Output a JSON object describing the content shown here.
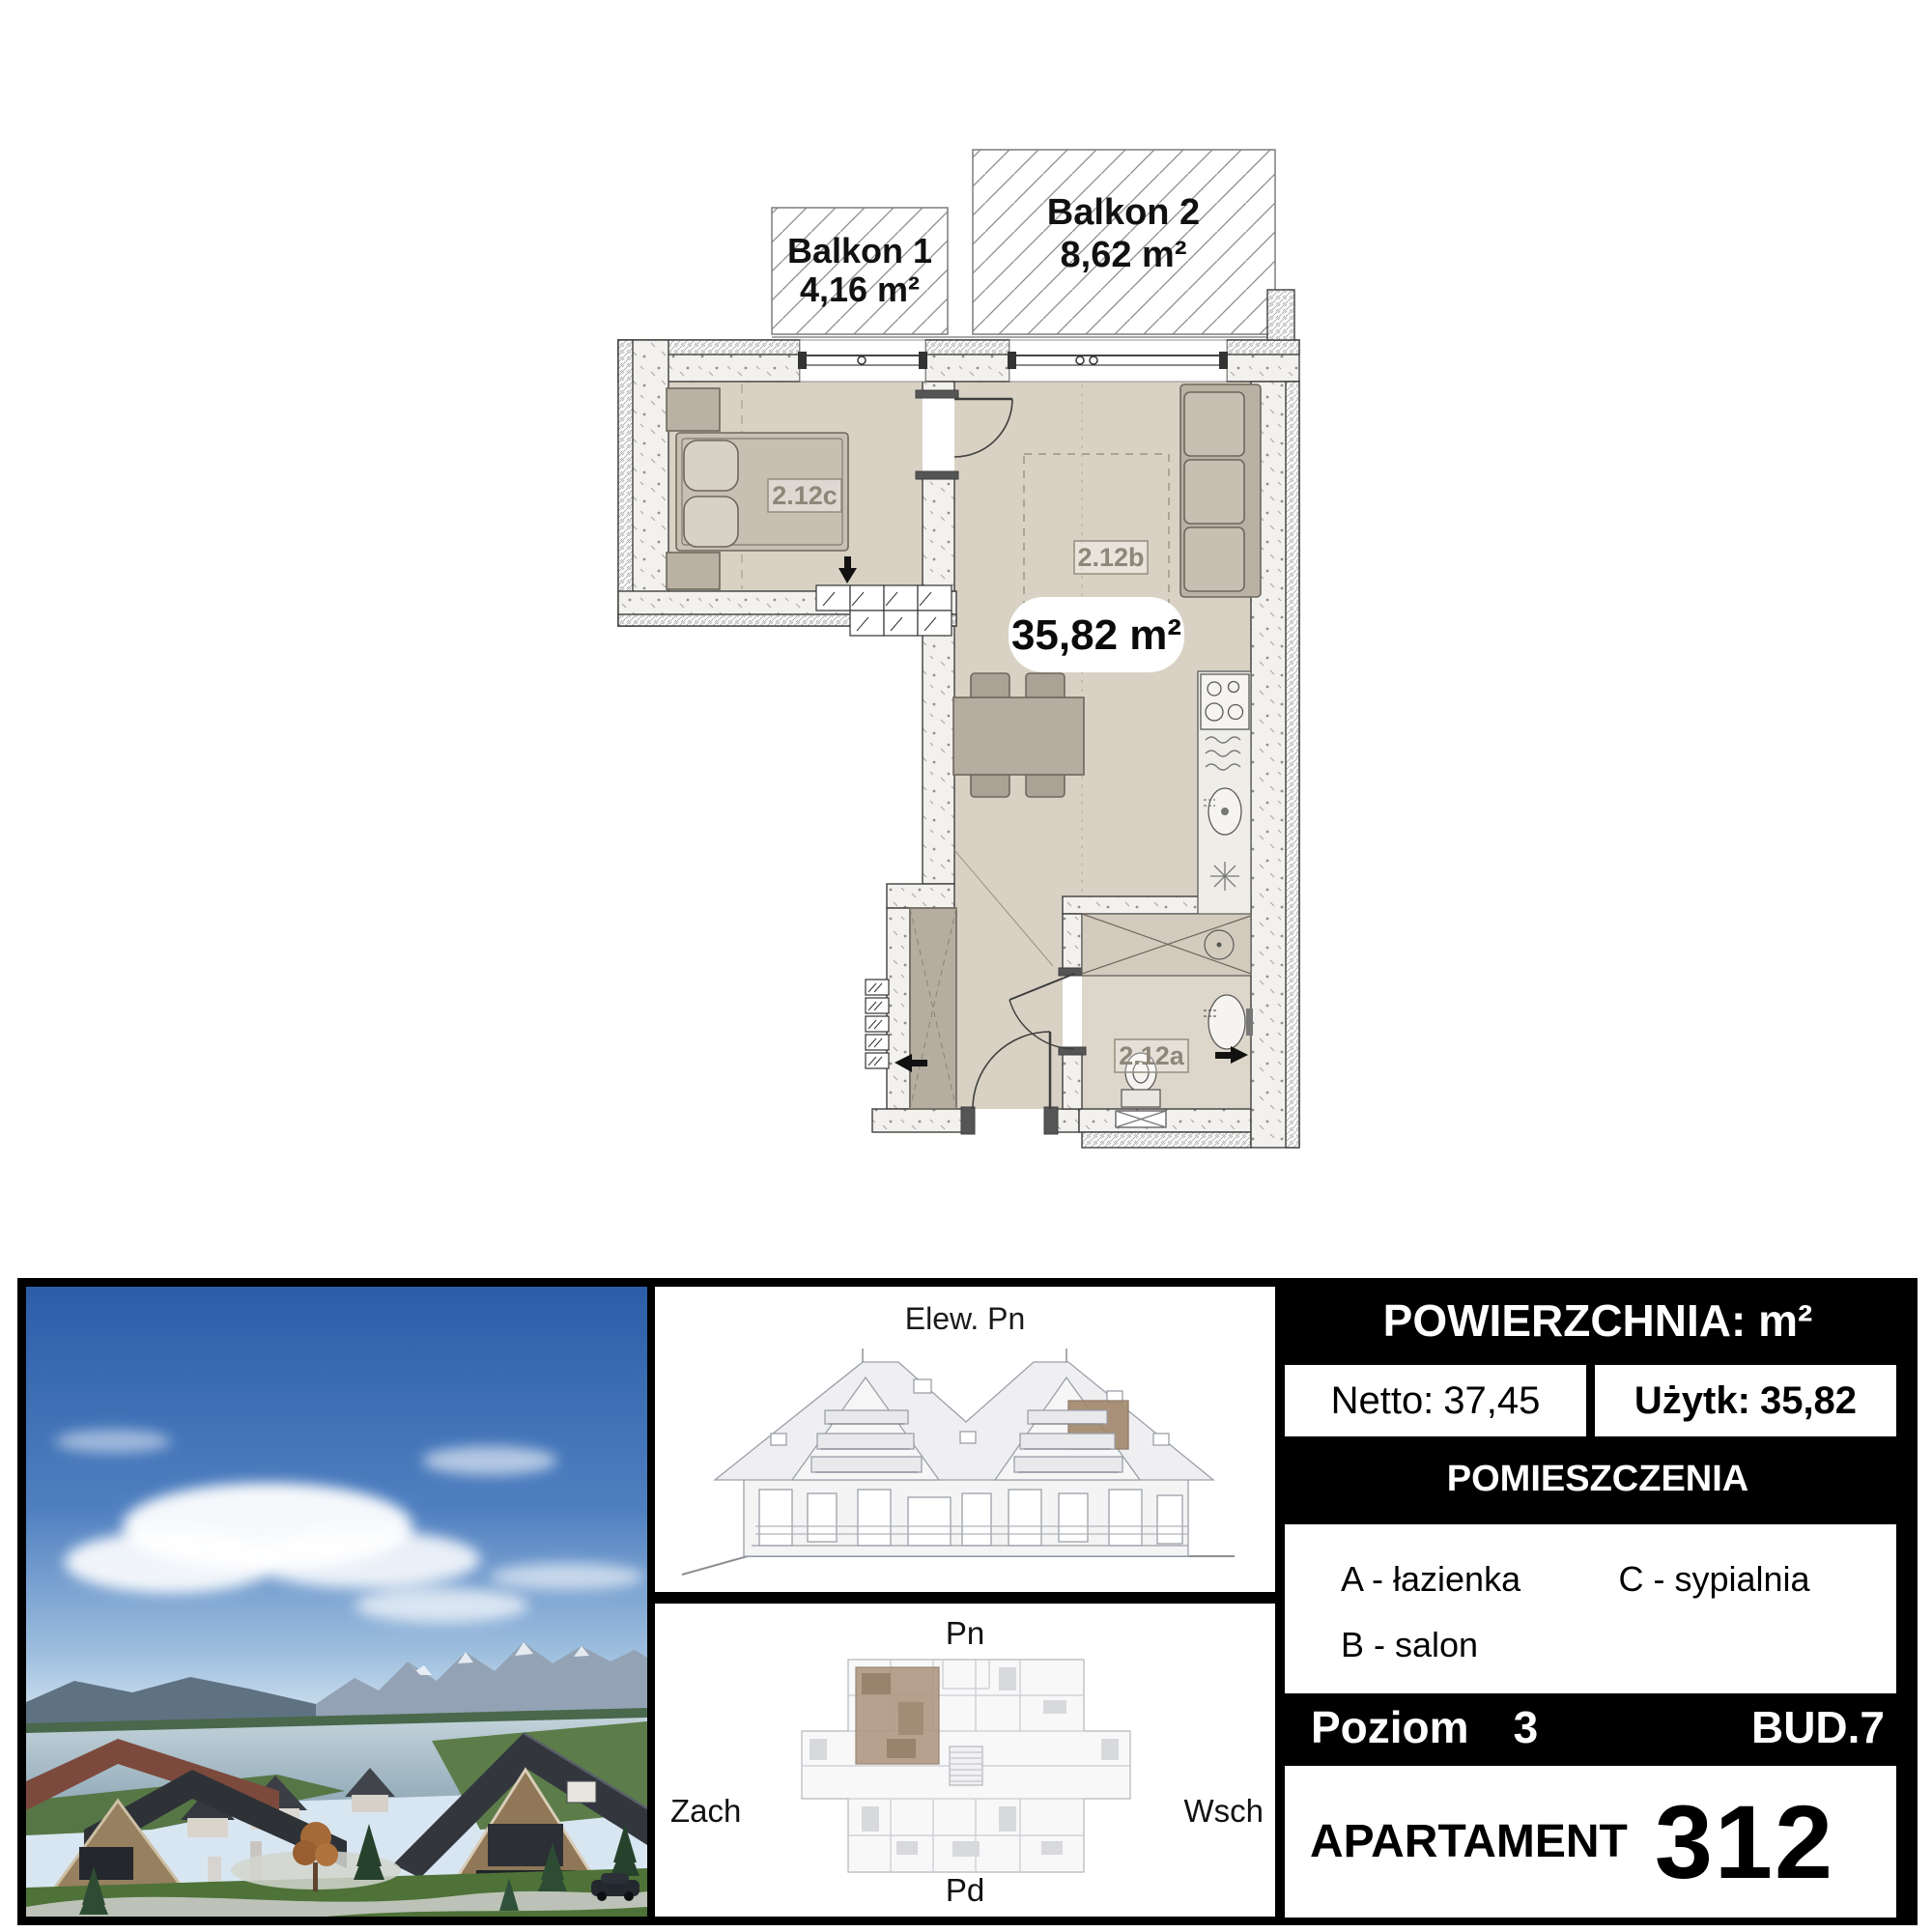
{
  "floor_plan": {
    "balcony1": {
      "name": "Balkon 1",
      "area": "4,16 m²"
    },
    "balcony2": {
      "name": "Balkon 2",
      "area": "8,62 m²"
    },
    "total_area": "35,82 m²",
    "rooms": {
      "bedroom": "2.12c",
      "living": "2.12b",
      "bathroom": "2.12a"
    }
  },
  "elevation": {
    "title": "Elew. Pn"
  },
  "keyplan": {
    "north": "Pn",
    "west": "Zach",
    "east": "Wsch",
    "south": "Pd"
  },
  "info": {
    "header": "POWIERZCHNIA: m²",
    "netto_label": "Netto:",
    "netto_value": "37,45",
    "uzytk_label": "Użytk:",
    "uzytk_value": "35,82",
    "rooms_header": "POMIESZCZENIA",
    "legend": {
      "a": "A - łazienka",
      "b": "B - salon",
      "c": "C - sypialnia"
    },
    "level_label": "Poziom",
    "level_value": "3",
    "building": "BUD.7",
    "apartment_label": "APARTAMENT",
    "apartment_number": "312"
  }
}
